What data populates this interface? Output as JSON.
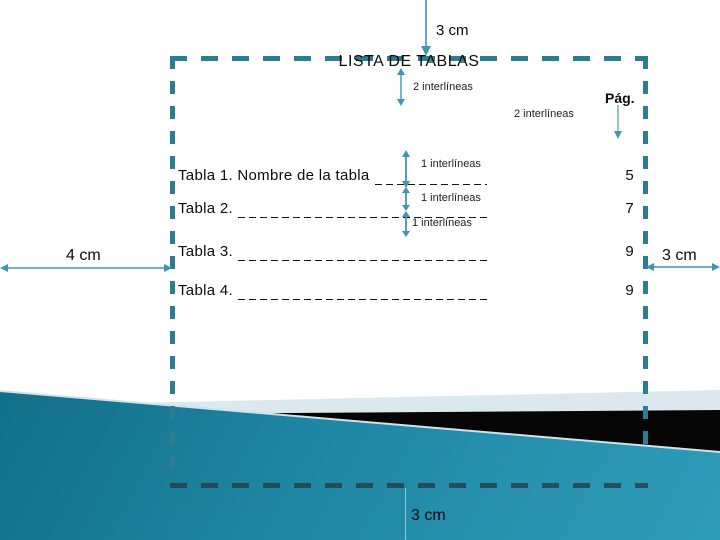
{
  "slide": {
    "title": "LISTA DE TABLAS",
    "page_column_header": "Pág."
  },
  "margin_labels": {
    "top": "3 cm",
    "left": "4 cm",
    "right": "3 cm",
    "bottom": "3 cm"
  },
  "spacing_annotations": {
    "below_title": "2 interlíneas",
    "above_entries": "2 interlíneas",
    "entry_1": "1 interlíneas",
    "entry_2": "1 interlíneas",
    "entry_3": "1 interlíneas"
  },
  "entries": [
    {
      "label": "Tabla 1. Nombre de la tabla",
      "page": "5"
    },
    {
      "label": "Tabla 2.",
      "page": "7"
    },
    {
      "label": "Tabla 3.",
      "page": "9"
    },
    {
      "label": "Tabla 4.",
      "page": "9"
    }
  ],
  "colors": {
    "dashed_border": "#2c7d91",
    "bottom_border_over_wedge": "#35606e",
    "arrow": "#3e96b2",
    "page_arrow": "#6fa9bf",
    "wedge_teal_dark": "#0d647c",
    "wedge_teal_light": "#2f9cba",
    "wedge_black": "#060606",
    "light_band": "#dce8ef",
    "leader_dash": "#151515"
  }
}
